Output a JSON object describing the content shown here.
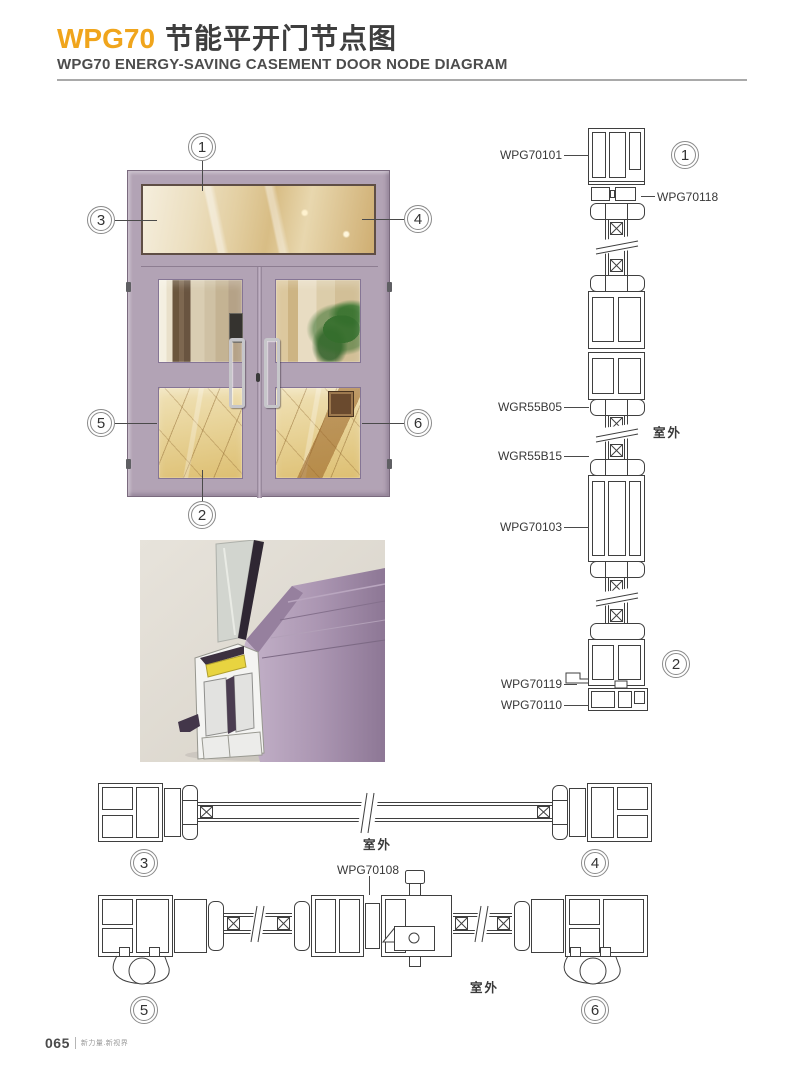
{
  "header": {
    "brand": "WPG70",
    "title_cn": "节能平开门节点图",
    "subtitle": "WPG70 ENERGY-SAVING CASEMENT DOOR NODE DIAGRAM"
  },
  "elevation": {
    "callout_1": "1",
    "callout_2": "2",
    "callout_3": "3",
    "callout_4": "4",
    "callout_5": "5",
    "callout_6": "6"
  },
  "vertical_section": {
    "callout_top": "1",
    "callout_bottom": "2",
    "label_frame_top": "WPG70101",
    "label_transom_insert": "WPG70118",
    "label_glazing_bead_top": "WGR55B05",
    "label_outside": "室外",
    "label_glazing_bead_bottom": "WGR55B15",
    "label_sash": "WPG70103",
    "label_drip": "WPG70119",
    "label_sill": "WPG70110"
  },
  "section_34": {
    "callout_left": "3",
    "callout_right": "4",
    "label_outside": "室外"
  },
  "section_56": {
    "callout_left": "5",
    "callout_right": "6",
    "label_center_mullion": "WPG70108",
    "label_outside": "室外"
  },
  "footer": {
    "page_number": "065",
    "tagline": "新力量.新视界"
  },
  "colors": {
    "brand_orange": "#F0A51C",
    "frame_lavender": "#B2A3B5",
    "drawing_line": "#3F3F3F"
  }
}
